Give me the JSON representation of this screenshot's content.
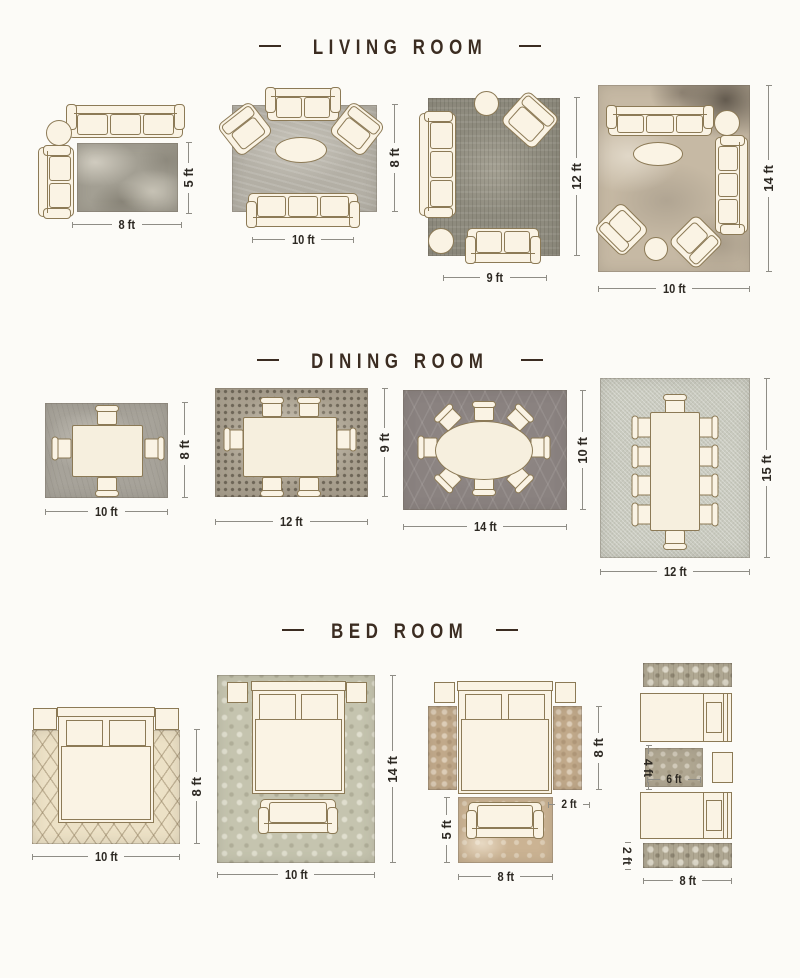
{
  "colors": {
    "background": "#fcfbf7",
    "title_text": "#3b2c21",
    "dim_text": "#2d2923",
    "furniture_fill": "#faf3e4",
    "furniture_outline": "#8c7a56"
  },
  "sections": [
    {
      "id": "living-room",
      "title": "LIVING ROOM",
      "layouts": [
        {
          "width_label": "8 ft",
          "height_label": "5 ft"
        },
        {
          "width_label": "10 ft",
          "height_label": "8 ft"
        },
        {
          "width_label": "9 ft",
          "height_label": "12 ft"
        },
        {
          "width_label": "10 ft",
          "height_label": "14 ft"
        }
      ]
    },
    {
      "id": "dining-room",
      "title": "DINING ROOM",
      "layouts": [
        {
          "width_label": "10 ft",
          "height_label": "8 ft"
        },
        {
          "width_label": "12 ft",
          "height_label": "9 ft"
        },
        {
          "width_label": "14 ft",
          "height_label": "10 ft"
        },
        {
          "width_label": "12 ft",
          "height_label": "15 ft"
        }
      ]
    },
    {
      "id": "bed-room",
      "title": "BED ROOM",
      "layouts": [
        {
          "width_label": "10 ft",
          "height_label": "8 ft"
        },
        {
          "width_label": "10 ft",
          "height_label": "14 ft"
        },
        {
          "runner_height_label": "8 ft",
          "runner_width_label": "2 ft",
          "front_rug_height_label": "5 ft",
          "front_rug_width_label": "8 ft"
        },
        {
          "accent_height_label": "4 ft",
          "accent_width_label": "6 ft",
          "runner_height_label": "2 ft",
          "runner_width_label": "8 ft"
        }
      ]
    }
  ]
}
